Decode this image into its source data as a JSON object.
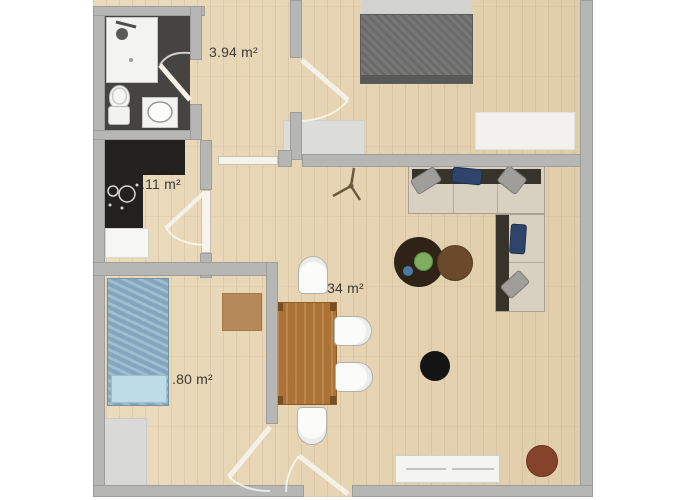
{
  "plan": {
    "type": "apartment-floor-plan",
    "rooms": {
      "hallway": {
        "area": "3.94 m²"
      },
      "kitchen": {
        "area": "3.11 m²"
      },
      "living_room": {
        "area": "0.34 m²"
      },
      "bedroom_small": {
        "area": ".80 m²"
      }
    },
    "furniture": [
      "shower",
      "toilet",
      "sink",
      "kitchen-counter",
      "cooktop",
      "appliance",
      "double-bed-gray",
      "single-bed-blue",
      "corner-sofa",
      "pillows",
      "coffee-table-dark",
      "coffee-table-brown",
      "dining-table",
      "dining-chairs",
      "pouf-black",
      "pouf-red",
      "sideboard",
      "white-rug",
      "gray-rug",
      "desk-mat",
      "ceiling-fan"
    ],
    "colors": {
      "background": "#ffffff",
      "wall": "#b6b6b4",
      "wood_floor": "#e7d3ae",
      "bathroom_floor": "#454440",
      "kitchen_counter": "#23211e",
      "bed_gray": "#707070",
      "bed_blue": "#8fb3c9",
      "sofa": "#d8d1c2",
      "pillow_navy": "#2e4468",
      "dining_table": "#b5793a",
      "chair": "#fbfbf9",
      "coffee_table_dark": "#2f2318",
      "coffee_table_brown": "#6a4a2b",
      "pouf_black": "#141414",
      "pouf_red": "#86432b",
      "label_text": "#3e3a35"
    }
  }
}
